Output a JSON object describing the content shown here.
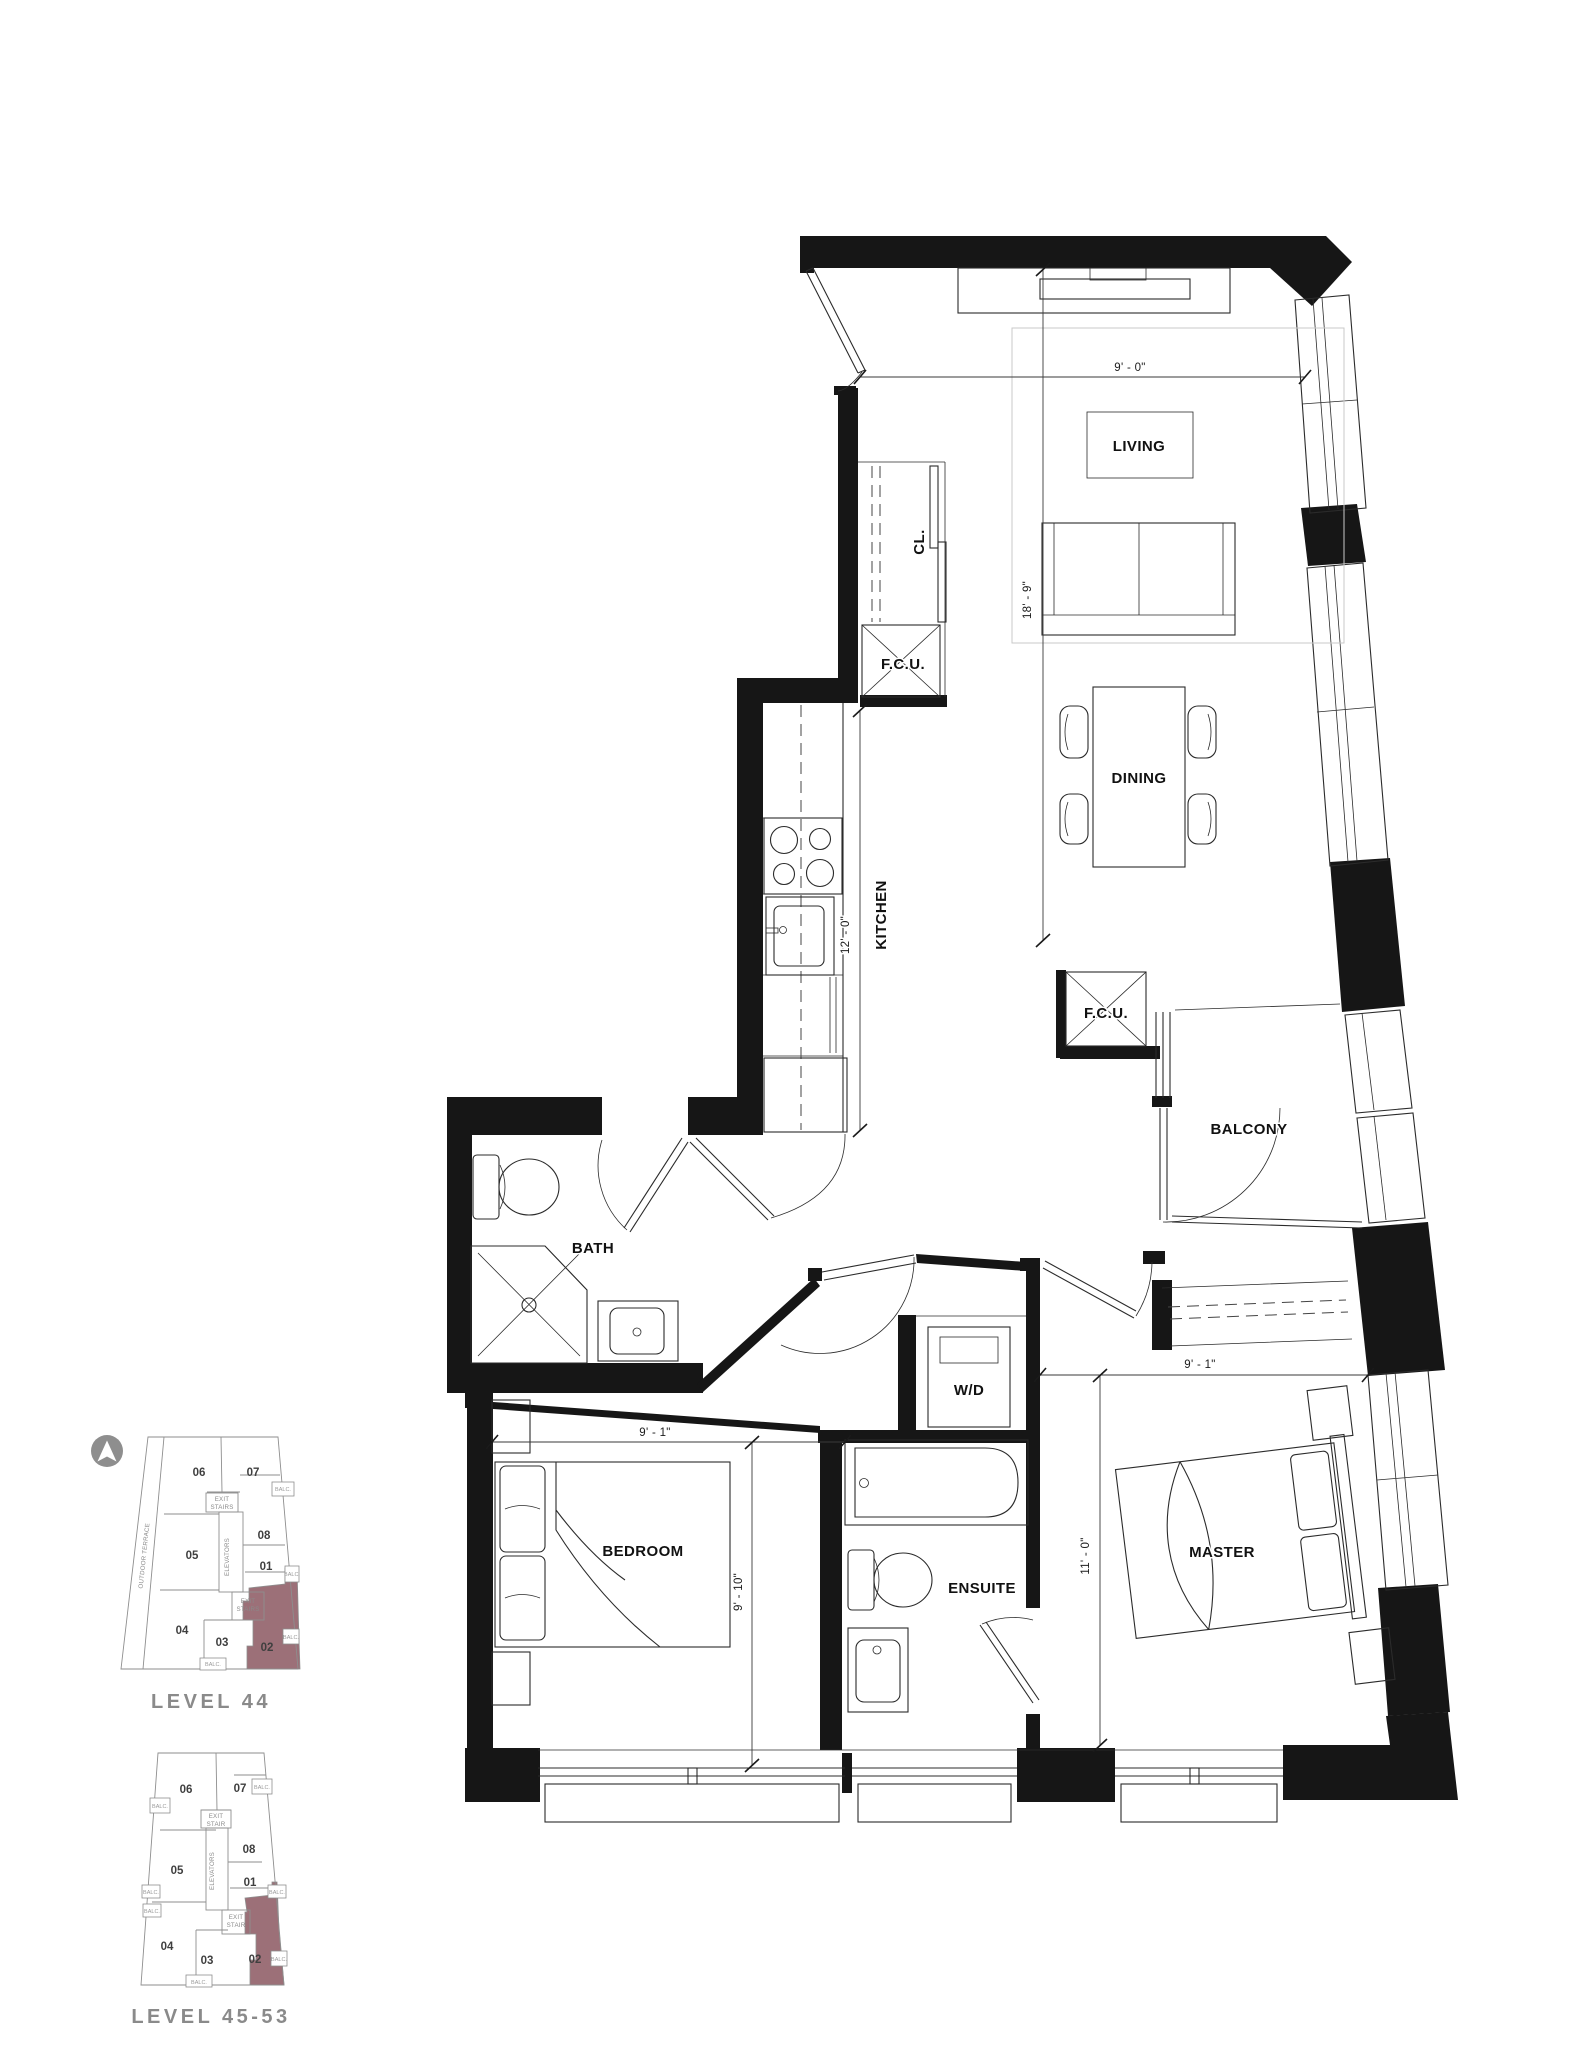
{
  "floorplan": {
    "rooms": {
      "living": "LIVING",
      "dining": "DINING",
      "kitchen": "KITCHEN",
      "closet": "CL.",
      "fcu": "F.C.U.",
      "balcony": "BALCONY",
      "bath": "BATH",
      "washer_dryer": "W/D",
      "ensuite": "ENSUITE",
      "bedroom": "BEDROOM",
      "master": "MASTER"
    },
    "dimensions": {
      "living_width": "9' - 0\"",
      "living_depth": "18' - 9\"",
      "kitchen_length": "12' - 0\"",
      "bedroom_width": "9' - 1\"",
      "bedroom_depth": "9' - 10\"",
      "master_width": "9' - 1\"",
      "master_depth": "11' - 0\""
    }
  },
  "keyplan": {
    "levels": [
      {
        "label": "LEVEL 44"
      },
      {
        "label": "LEVEL 45-53"
      }
    ],
    "highlighted_unit": "02",
    "units": {
      "u01": "01",
      "u02": "02",
      "u03": "03",
      "u04": "04",
      "u05": "05",
      "u06": "06",
      "u07": "07",
      "u08": "08"
    },
    "labels": {
      "exit": "EXIT",
      "stairs": "STAIRS",
      "stair": "STAIR",
      "elevators": "ELEVATORS",
      "outdoor_terrace": "OUTDOOR TERRACE",
      "balc": "BALC."
    }
  },
  "colors": {
    "wall": "#161616",
    "line": "#2B2B2B",
    "light_line": "#C9C9C9",
    "highlight": "#9C7078",
    "keyplan_line": "#8E8E8E",
    "level_text": "#8A8A8A"
  }
}
